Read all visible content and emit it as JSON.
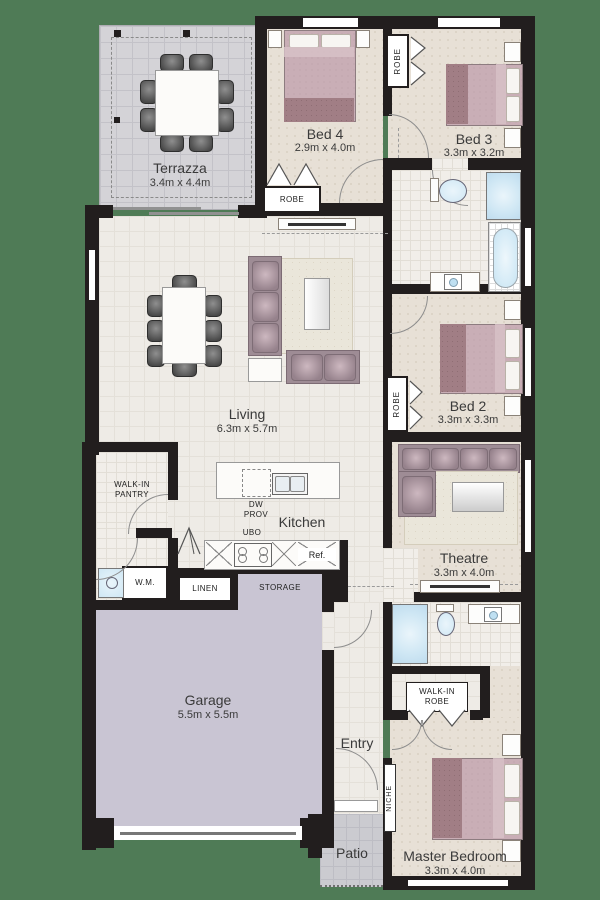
{
  "plan_title": "floor-plan",
  "colors": {
    "background": "#4f7b56",
    "wall": "#221e1e",
    "floor_cream": "#eeebe6",
    "floor_bedroom": "#e7e0d6",
    "terrazza_gray": "#d4d3d7",
    "garage_lavender": "#c9c5d3",
    "bed_mauve": "#c9aeb6",
    "sofa_mauve": "#9e8c95",
    "water_blue": "#cfe7f4"
  },
  "rooms": {
    "terrazza": {
      "label": "Terrazza",
      "dims": "3.4m x 4.4m"
    },
    "bed4": {
      "label": "Bed 4",
      "dims": "2.9m x 4.0m"
    },
    "bed3": {
      "label": "Bed 3",
      "dims": "3.3m x 3.2m"
    },
    "living": {
      "label": "Living",
      "dims": "6.3m x 5.7m"
    },
    "bed2": {
      "label": "Bed 2",
      "dims": "3.3m x 3.3m"
    },
    "kitchen": {
      "label": "Kitchen"
    },
    "theatre": {
      "label": "Theatre",
      "dims": "3.3m x 4.0m"
    },
    "garage": {
      "label": "Garage",
      "dims": "5.5m x 5.5m"
    },
    "entry": {
      "label": "Entry"
    },
    "patio": {
      "label": "Patio"
    },
    "master": {
      "label": "Master Bedroom",
      "dims": "3.3m x 4.0m"
    }
  },
  "fixtures": {
    "robe": "ROBE",
    "walk_in_pantry": "WALK-IN\nPANTRY",
    "walk_in_robe": "WALK-IN\nROBE",
    "wm": "W.M.",
    "linen": "LINEN",
    "storage": "STORAGE",
    "niche": "NICHE",
    "ubo": "UBO",
    "ref": "Ref.",
    "dw_prov": "DW\nPROV"
  }
}
